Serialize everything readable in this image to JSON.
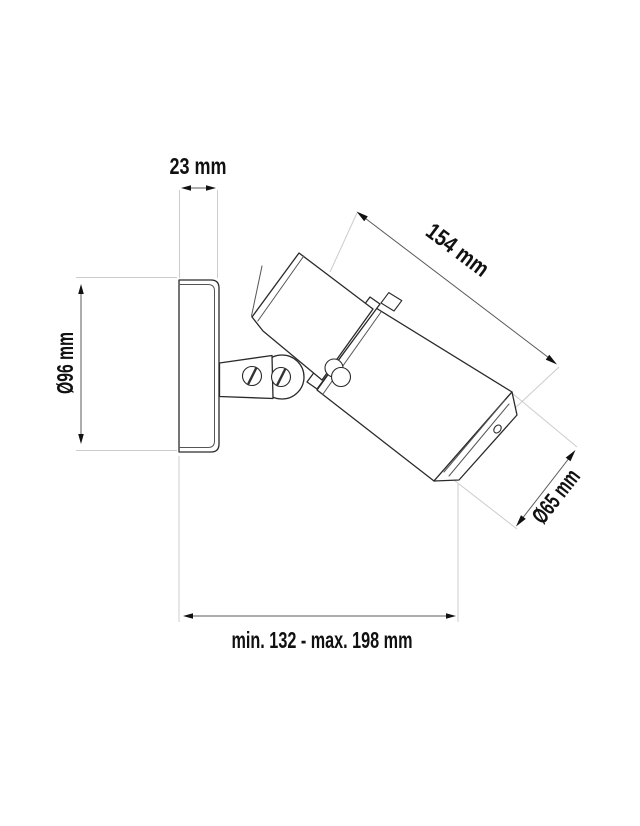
{
  "page": {
    "background": "#ffffff"
  },
  "drawing": {
    "type": "technical-dimension-drawing",
    "subject": "wall-mounted adjustable spotlight, side view",
    "parts": [
      "wall mounting plate",
      "mounting arm",
      "pivot knuckle",
      "bracket screws",
      "adjustment knob",
      "lamp head",
      "bezel ring",
      "lamp body",
      "mounting tab",
      "rear cap"
    ],
    "colors": {
      "fill": "#ffffff",
      "outline": "#2a2a2a",
      "detail": "#555555",
      "extension_line": "#cccccc",
      "dimension_line": "#5a5a5a",
      "arrowhead": "#111111",
      "label_text": "#111111"
    }
  },
  "dimensions": {
    "plate_depth": {
      "label": "23 mm"
    },
    "plate_diameter": {
      "label": "Ø96 mm"
    },
    "body_length": {
      "label": "154 mm"
    },
    "head_diameter": {
      "label": "Ø65 mm"
    },
    "projection": {
      "label": "min. 132 - max. 198 mm"
    }
  }
}
